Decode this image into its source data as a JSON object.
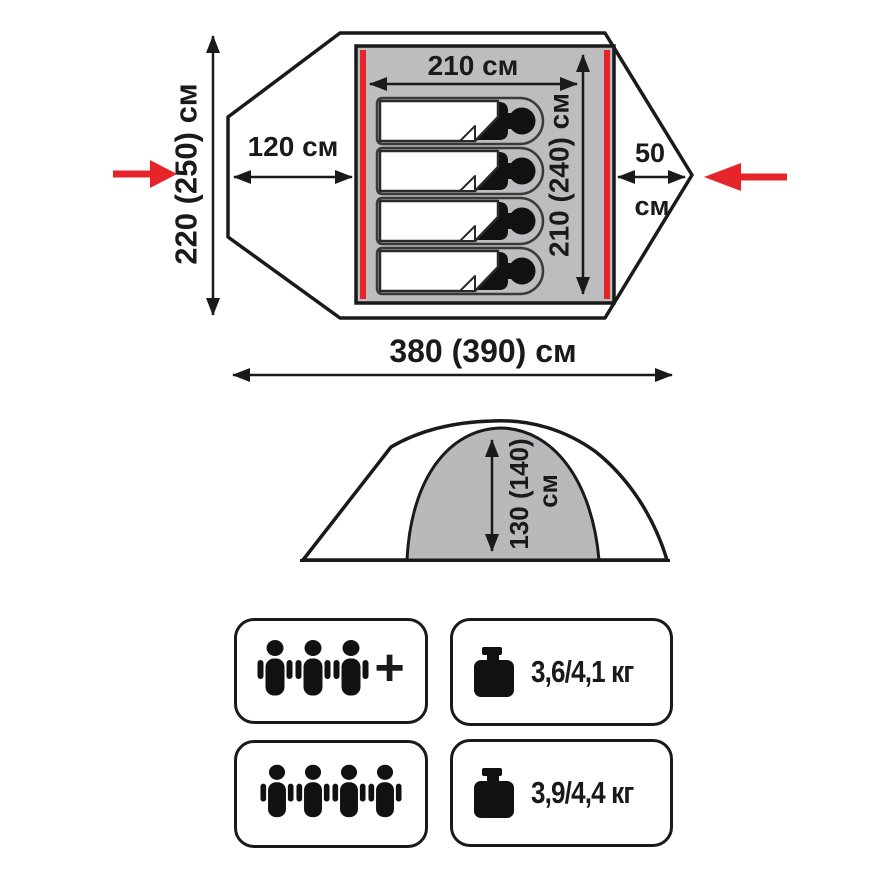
{
  "title": "Tent dimensions diagram",
  "top_view": {
    "total_width_label": "380 (390) см",
    "total_depth_label": "220 (250) см",
    "inner_width_label": "210 см",
    "inner_depth_label": "210 (240) см",
    "vestibule_depth_label": "120 см",
    "rear_vestibule_value": "50",
    "rear_vestibule_unit": "см",
    "sleeping_bag_count": 4
  },
  "side_view": {
    "inner_height_value": "130 (140)",
    "inner_height_unit": "см"
  },
  "specs": {
    "capacity_primary": {
      "person_count": 3,
      "plus_label": "+"
    },
    "capacity_max": {
      "person_count": 4
    },
    "weight_primary_label": "3,6/4,1 кг",
    "weight_max_label": "3,9/4,4 кг"
  },
  "colors": {
    "accent_red": "#e6252a",
    "floor_gray": "#bdbdc0",
    "dome_gray": "#b9b9bc",
    "line_black": "#1a1a1a"
  }
}
